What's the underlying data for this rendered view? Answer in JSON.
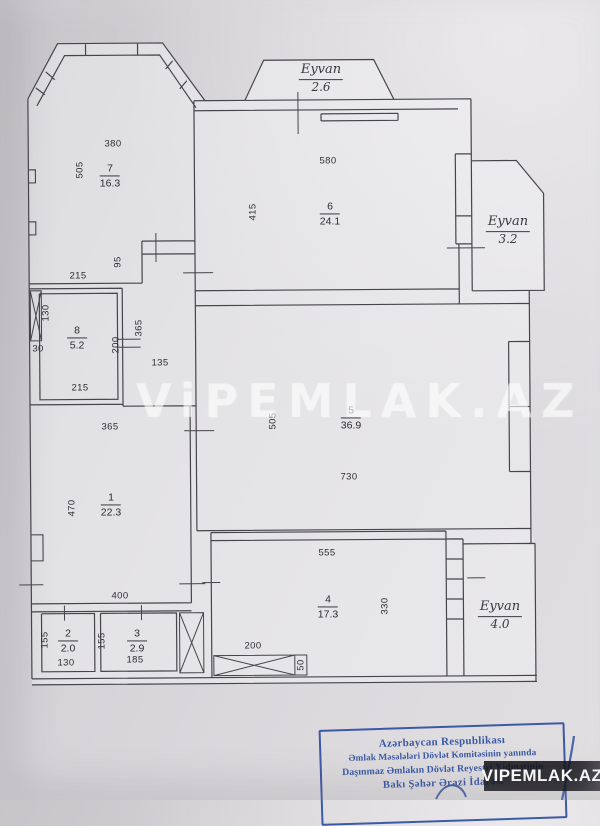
{
  "watermark_text": "ViPEMLAK.AZ",
  "brand_badge": "VIPEMLAK.AZ",
  "stamp": {
    "lines": [
      "Azərbaycan Respublikası",
      "Əmlak Məsələləri Dövlət Komitəsinin yanında",
      "Daşınmaz Əmlakın Dövlət Reyestri Xidmətinin",
      "Bakı Şəhər Ərazi İdarəsi"
    ],
    "ink_color": "#2e4fa0"
  },
  "colors": {
    "paper": "#d7d5d8",
    "plan_line": "#46454a",
    "badge_bg": "#101116",
    "watermark": "rgba(255,255,255,0.52)"
  },
  "plan": {
    "rooms": [
      {
        "number": "7",
        "area": "16.3",
        "x": 110,
        "y": 176
      },
      {
        "number": "6",
        "area": "24.1",
        "x": 330,
        "y": 214
      },
      {
        "number": "8",
        "area": "5.2",
        "x": 77,
        "y": 338
      },
      {
        "number": "5",
        "area": "36.9",
        "x": 351,
        "y": 418
      },
      {
        "number": "1",
        "area": "22.3",
        "x": 111,
        "y": 505
      },
      {
        "number": "2",
        "area": "2.0",
        "x": 68,
        "y": 641
      },
      {
        "number": "3",
        "area": "2.9",
        "x": 137,
        "y": 641
      },
      {
        "number": "4",
        "area": "17.3",
        "x": 328,
        "y": 607
      }
    ],
    "balconies": [
      {
        "label": "Eyvan",
        "area": "2.6",
        "x": 321,
        "y": 79
      },
      {
        "label": "Eyvan",
        "area": "3.2",
        "x": 508,
        "y": 231
      },
      {
        "label": "Eyvan",
        "area": "4.0",
        "x": 500,
        "y": 616
      }
    ],
    "dimensions": [
      {
        "t": "380",
        "x": 113,
        "y": 144,
        "r": 0
      },
      {
        "t": "505",
        "x": 80,
        "y": 170,
        "r": 1
      },
      {
        "t": "580",
        "x": 328,
        "y": 161,
        "r": 0
      },
      {
        "t": "415",
        "x": 253,
        "y": 212,
        "r": 1
      },
      {
        "t": "215",
        "x": 78,
        "y": 276,
        "r": 0
      },
      {
        "t": "95",
        "x": 118,
        "y": 262,
        "r": 1
      },
      {
        "t": "130",
        "x": 46,
        "y": 313,
        "r": 1
      },
      {
        "t": "30",
        "x": 38,
        "y": 349,
        "r": 0
      },
      {
        "t": "215",
        "x": 80,
        "y": 388,
        "r": 0
      },
      {
        "t": "365",
        "x": 139,
        "y": 328,
        "r": 1
      },
      {
        "t": "200",
        "x": 116,
        "y": 345,
        "r": 1
      },
      {
        "t": "135",
        "x": 160,
        "y": 363,
        "r": 0
      },
      {
        "t": "365",
        "x": 110,
        "y": 427,
        "r": 0
      },
      {
        "t": "470",
        "x": 72,
        "y": 508,
        "r": 1
      },
      {
        "t": "400",
        "x": 120,
        "y": 596,
        "r": 0
      },
      {
        "t": "155",
        "x": 45,
        "y": 640,
        "r": 1
      },
      {
        "t": "130",
        "x": 66,
        "y": 663,
        "r": 0
      },
      {
        "t": "155",
        "x": 102,
        "y": 641,
        "r": 1
      },
      {
        "t": "185",
        "x": 135,
        "y": 660,
        "r": 0
      },
      {
        "t": "505",
        "x": 273,
        "y": 421,
        "r": 1
      },
      {
        "t": "730",
        "x": 349,
        "y": 477,
        "r": 0
      },
      {
        "t": "555",
        "x": 327,
        "y": 553,
        "r": 0
      },
      {
        "t": "330",
        "x": 385,
        "y": 606,
        "r": 1
      },
      {
        "t": "200",
        "x": 253,
        "y": 646,
        "r": 0
      },
      {
        "t": "50",
        "x": 301,
        "y": 665,
        "r": 1
      }
    ]
  }
}
